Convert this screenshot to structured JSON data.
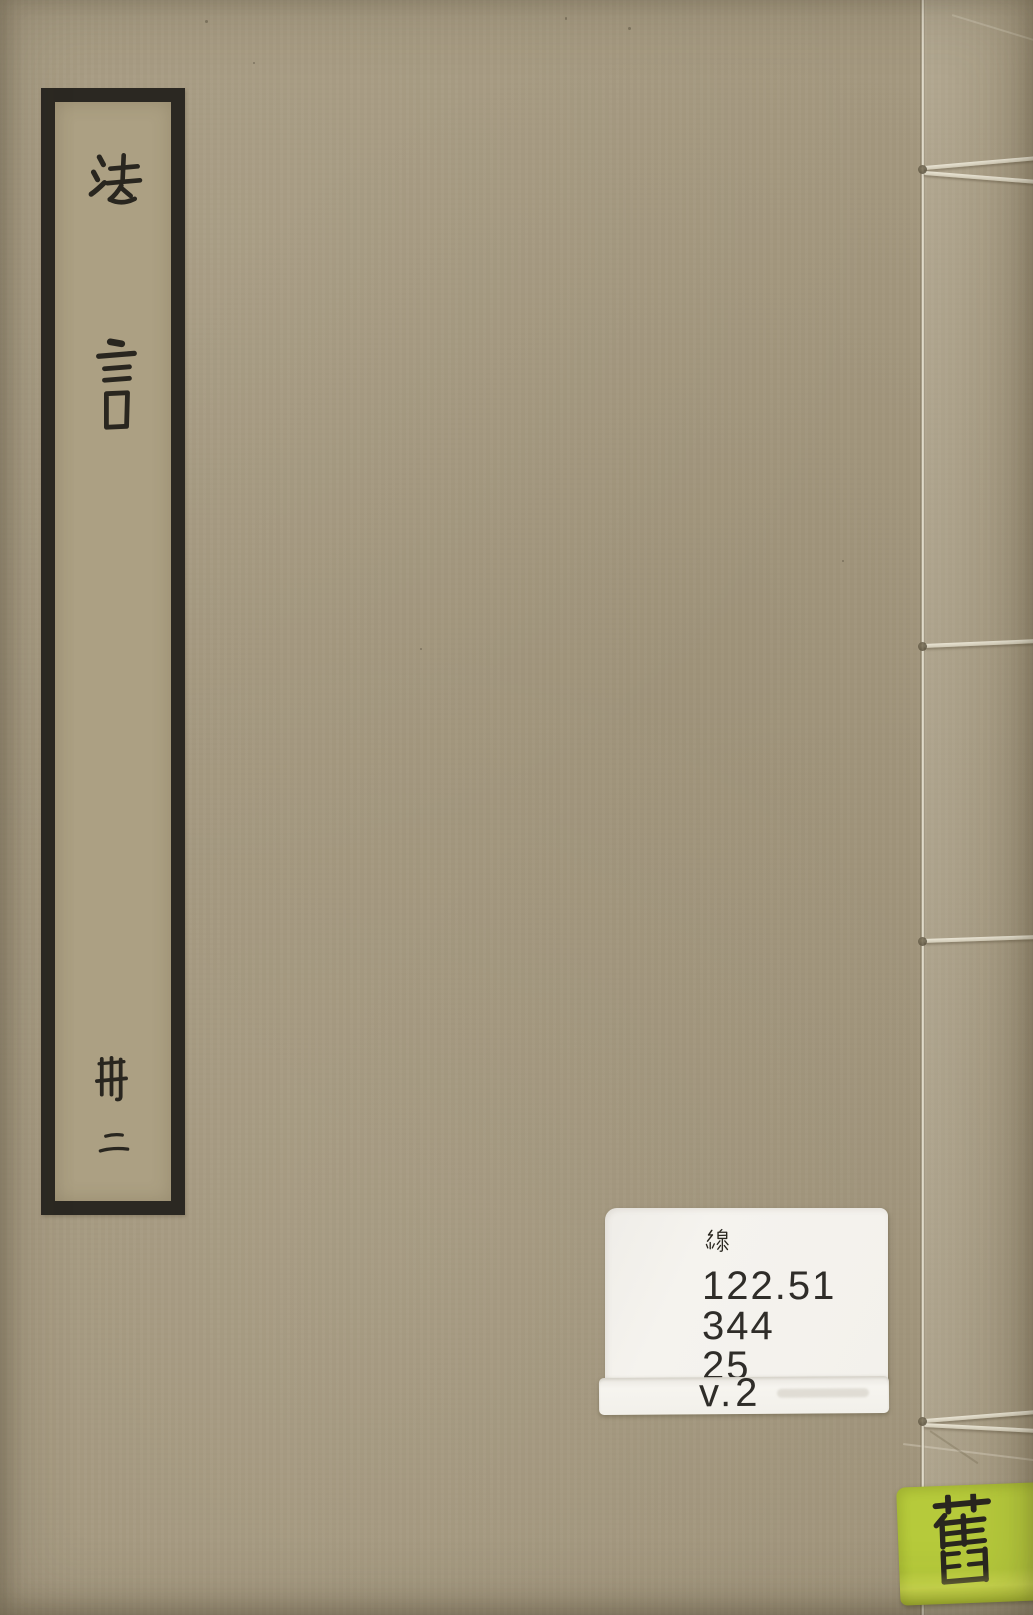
{
  "book": {
    "title_label": {
      "title_chars": [
        "法",
        "言"
      ],
      "volume_chars": [
        "冊",
        "二"
      ]
    },
    "call_number_label": {
      "heading_char": "線",
      "call_lines": [
        "122.51",
        "344",
        "25"
      ],
      "volume_line": "v.2"
    },
    "condition_label": {
      "char": "舊"
    }
  },
  "colors": {
    "cover": "#a3977e",
    "ink": "#29261f",
    "call_label_bg": "#f3f1ec",
    "condition_label_bg": "#b6ca3b",
    "thread": "#ddd7c6"
  }
}
